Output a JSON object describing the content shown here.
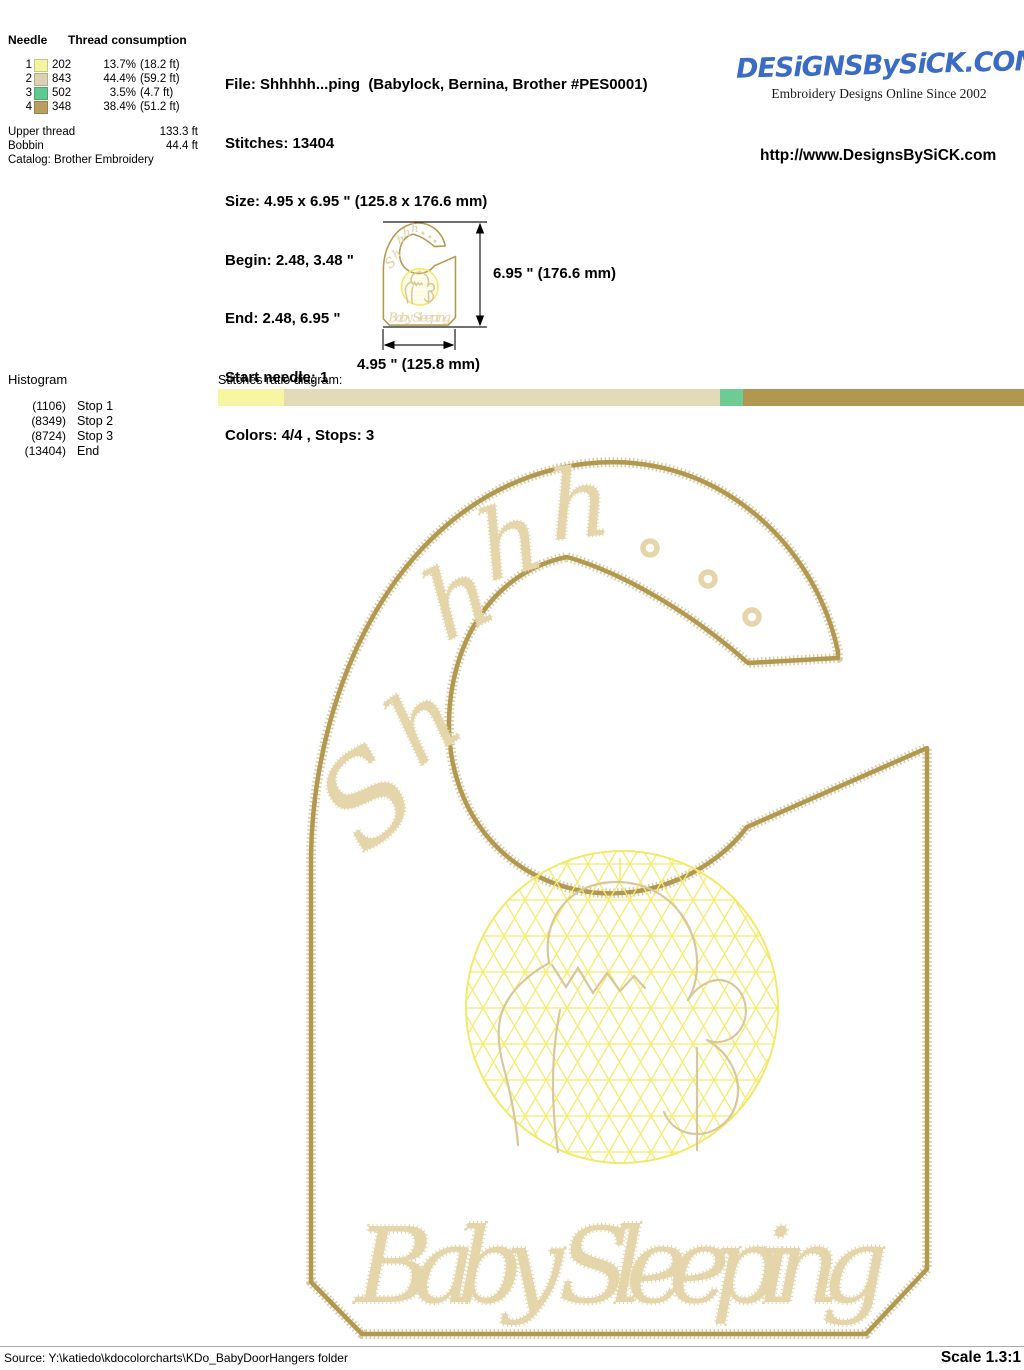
{
  "header": {
    "needle_table": {
      "col_needle": "Needle",
      "col_thread": "Thread consumption",
      "rows": [
        {
          "needle": "1",
          "color": "#F5F2A0",
          "code": "202",
          "percent": "13.7%",
          "length": "(18.2 ft)"
        },
        {
          "needle": "2",
          "color": "#DCD2B3",
          "code": "843",
          "percent": "44.4%",
          "length": "(59.2 ft)"
        },
        {
          "needle": "3",
          "color": "#5FC98F",
          "code": "502",
          "percent": "3.5%",
          "length": "(4.7 ft)"
        },
        {
          "needle": "4",
          "color": "#B99E61",
          "code": "348",
          "percent": "38.4%",
          "length": "(51.2 ft)"
        }
      ],
      "upper_thread_label": "Upper thread",
      "upper_thread_value": "133.3 ft",
      "bobbin_label": "Bobbin",
      "bobbin_value": "44.4 ft",
      "catalog": "Catalog: Brother Embroidery"
    },
    "file_info": {
      "file": "File: Shhhhh...ping  (Babylock, Bernina, Brother #PES0001)",
      "stitches": "Stitches: 13404",
      "size": "Size: 4.95 x 6.95 \" (125.8 x 176.6 mm)",
      "begin": "Begin: 2.48, 3.48 \"",
      "end": "End: 2.48, 6.95 \"",
      "start_needle": "Start needle: 1",
      "colors": "Colors: 4/4 , Stops: 3"
    },
    "brand": {
      "logo_text": "DESiGNSBySiCK.COM",
      "logo_color": "#3A6BC5",
      "tagline": "Embroidery Designs Online Since 2002",
      "url": "http://www.DesignsBySiCK.com"
    }
  },
  "dimensions": {
    "height_label": "6.95 \" (176.6 mm)",
    "width_label": "4.95 \" (125.8 mm)"
  },
  "histogram": {
    "title": "Histogram",
    "rows": [
      {
        "count": "(1106)",
        "label": "Stop 1"
      },
      {
        "count": "(8349)",
        "label": "Stop 2"
      },
      {
        "count": "(8724)",
        "label": "Stop 3"
      },
      {
        "count": "(13404)",
        "label": "End"
      }
    ]
  },
  "ratio_diagram": {
    "label": "Stitches ratio diagram:",
    "segments": [
      {
        "color": "#F8F6A3",
        "width": "8.25%"
      },
      {
        "color": "#E3DABA",
        "width": "54.04%"
      },
      {
        "color": "#6FCB94",
        "width": "2.80%"
      },
      {
        "color": "#B19851",
        "width": "34.91%"
      }
    ]
  },
  "design": {
    "arc_letters": {
      "l0": "S",
      "l1": "h",
      "l2": "h",
      "l3": "h",
      "l4": "h"
    },
    "caption": "Baby Sleeping",
    "outline_color": "#B3994F",
    "lettering_color": "#E4D5AA",
    "mesh_color": "#F4EC6A",
    "figure_color": "#D9C79B"
  },
  "footer": {
    "source": "Source: Y:\\katiedo\\kdocolorcharts\\KDo_BabyDoorHangers folder",
    "scale": "Scale 1.3:1"
  }
}
